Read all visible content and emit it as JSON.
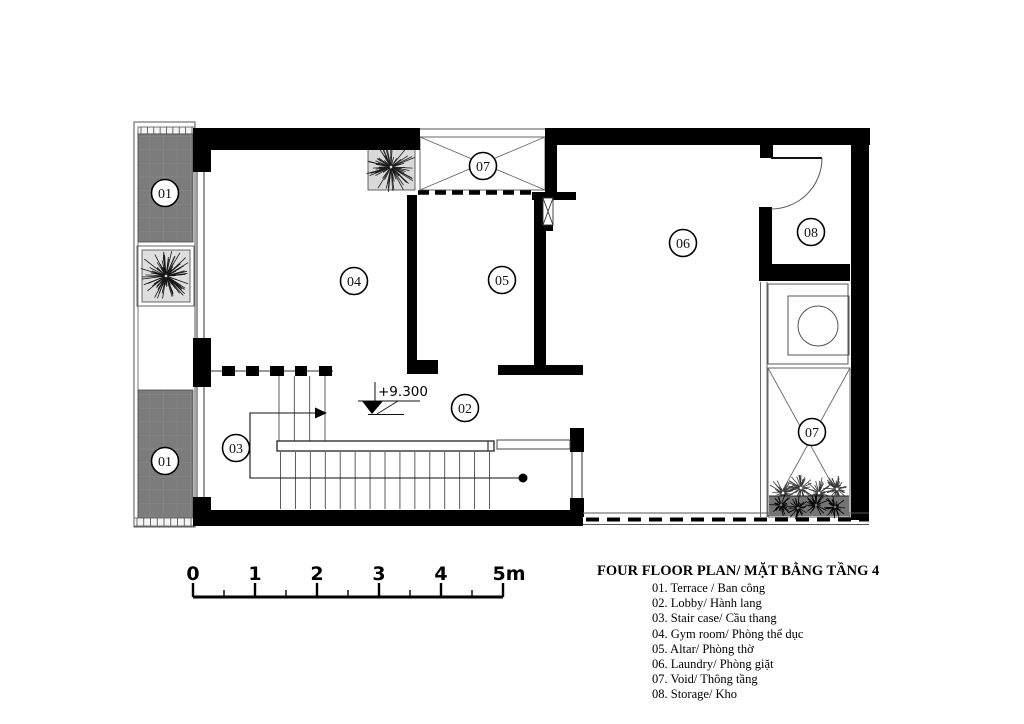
{
  "plan": {
    "level_annotation": "+9.300",
    "room_labels": {
      "terrace_top": "01",
      "terrace_bottom": "01",
      "lobby": "02",
      "stairs": "03",
      "gym": "04",
      "altar": "05",
      "laundry": "06",
      "void_top": "07",
      "void_right": "07",
      "storage": "08"
    },
    "colors": {
      "wall": "#000000",
      "terrace_fill": "#7c7c7c",
      "paper": "#ffffff"
    }
  },
  "scale_bar": {
    "labels": [
      "0",
      "1",
      "2",
      "3",
      "4",
      "5m"
    ]
  },
  "legend": {
    "title": "FOUR FLOOR PLAN/ MẶT BẰNG TẦNG 4",
    "items": [
      "01. Terrace / Ban công",
      "02. Lobby/ Hành lang",
      "03. Stair case/ Cầu thang",
      "04. Gym room/ Phòng thể dục",
      "05. Altar/ Phòng thờ",
      "06. Laundry/ Phòng giặt",
      "07. Void/ Thông tầng",
      "08. Storage/ Kho"
    ]
  }
}
